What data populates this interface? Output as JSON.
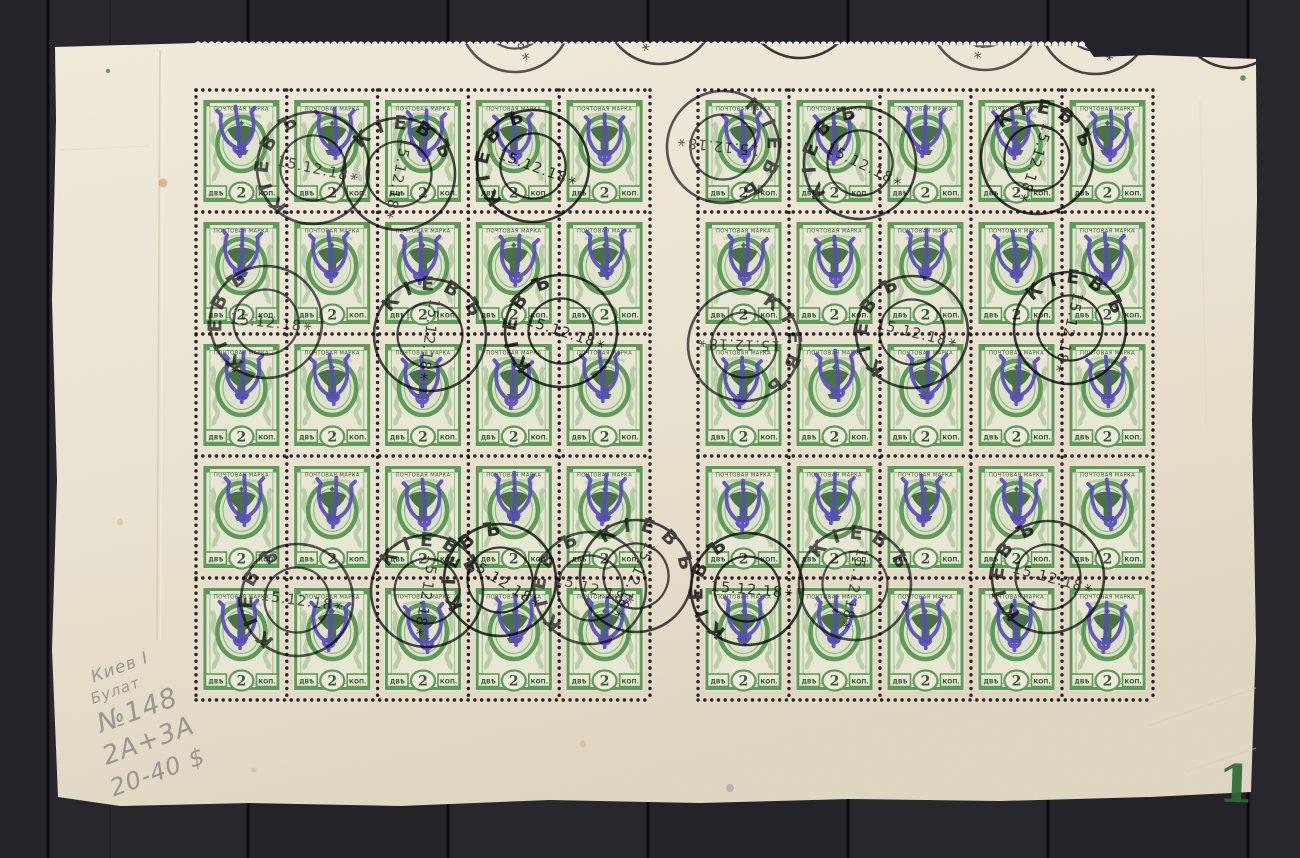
{
  "photo_subject": "Full sheet of fifty 2 kop green stamps with violet trident overprints and Kiev postmarks on dark plank background",
  "scene": {
    "background": {
      "base": "#242329",
      "plank_alt": "#28272e",
      "seam_color": "#0b0b0d",
      "seam_xs": [
        48,
        248,
        448,
        648,
        848,
        1048,
        1248
      ]
    },
    "paper": {
      "light": "#f2ecdd",
      "mid": "#ece4d2",
      "dark": "#e1d8c3"
    }
  },
  "sheet": {
    "plate_number": "1",
    "plate_color": "#2e6b34",
    "panes": [
      {
        "x": 196,
        "y": 90,
        "cols": 5,
        "rows": 5,
        "cell_w": 90.8,
        "cell_h": 122
      },
      {
        "x": 698,
        "y": 90,
        "cols": 5,
        "rows": 5,
        "cell_w": 91.0,
        "cell_h": 122
      }
    ]
  },
  "stamp": {
    "top_text": "ПОЧТОВАЯ МАРКА",
    "left_label": "ДВѢ",
    "value": "2",
    "right_label": "КОП.",
    "frame_color": "#5e9a58",
    "frame_light": "#8ab47e",
    "dark_color": "#2f5e33",
    "pale_color": "#e8e7d3",
    "oval_bg": "#dde3c8",
    "value_bg": "#eeeadb",
    "overprint_color": "#5a4cc2"
  },
  "cancels": {
    "town": "КІЕВЪ",
    "date": "15.12.18",
    "star": "*",
    "ink": "#1d1d1f",
    "strikes": [
      [
        515,
        16,
        -15
      ],
      [
        660,
        8,
        20
      ],
      [
        800,
        2,
        -30
      ],
      [
        985,
        14,
        10
      ],
      [
        1095,
        18,
        -20
      ],
      [
        1233,
        12,
        25
      ],
      [
        313,
        168,
        -78
      ],
      [
        399,
        174,
        12
      ],
      [
        533,
        166,
        -70
      ],
      [
        723,
        147,
        96
      ],
      [
        860,
        163,
        -64
      ],
      [
        1037,
        158,
        18
      ],
      [
        266,
        322,
        -84
      ],
      [
        430,
        335,
        8
      ],
      [
        561,
        331,
        -72
      ],
      [
        744,
        345,
        92
      ],
      [
        912,
        332,
        -76
      ],
      [
        1070,
        328,
        14
      ],
      [
        297,
        600,
        -82
      ],
      [
        427,
        591,
        10
      ],
      [
        500,
        580,
        -58
      ],
      [
        590,
        588,
        -74
      ],
      [
        636,
        576,
        24
      ],
      [
        747,
        589,
        -85
      ],
      [
        855,
        584,
        12
      ],
      [
        1048,
        577,
        -75
      ]
    ]
  },
  "handwriting": {
    "color": "#8b8a83",
    "lines": [
      "Киев I",
      "Булат",
      "№148",
      "2А+3А",
      "20-40 $"
    ]
  }
}
